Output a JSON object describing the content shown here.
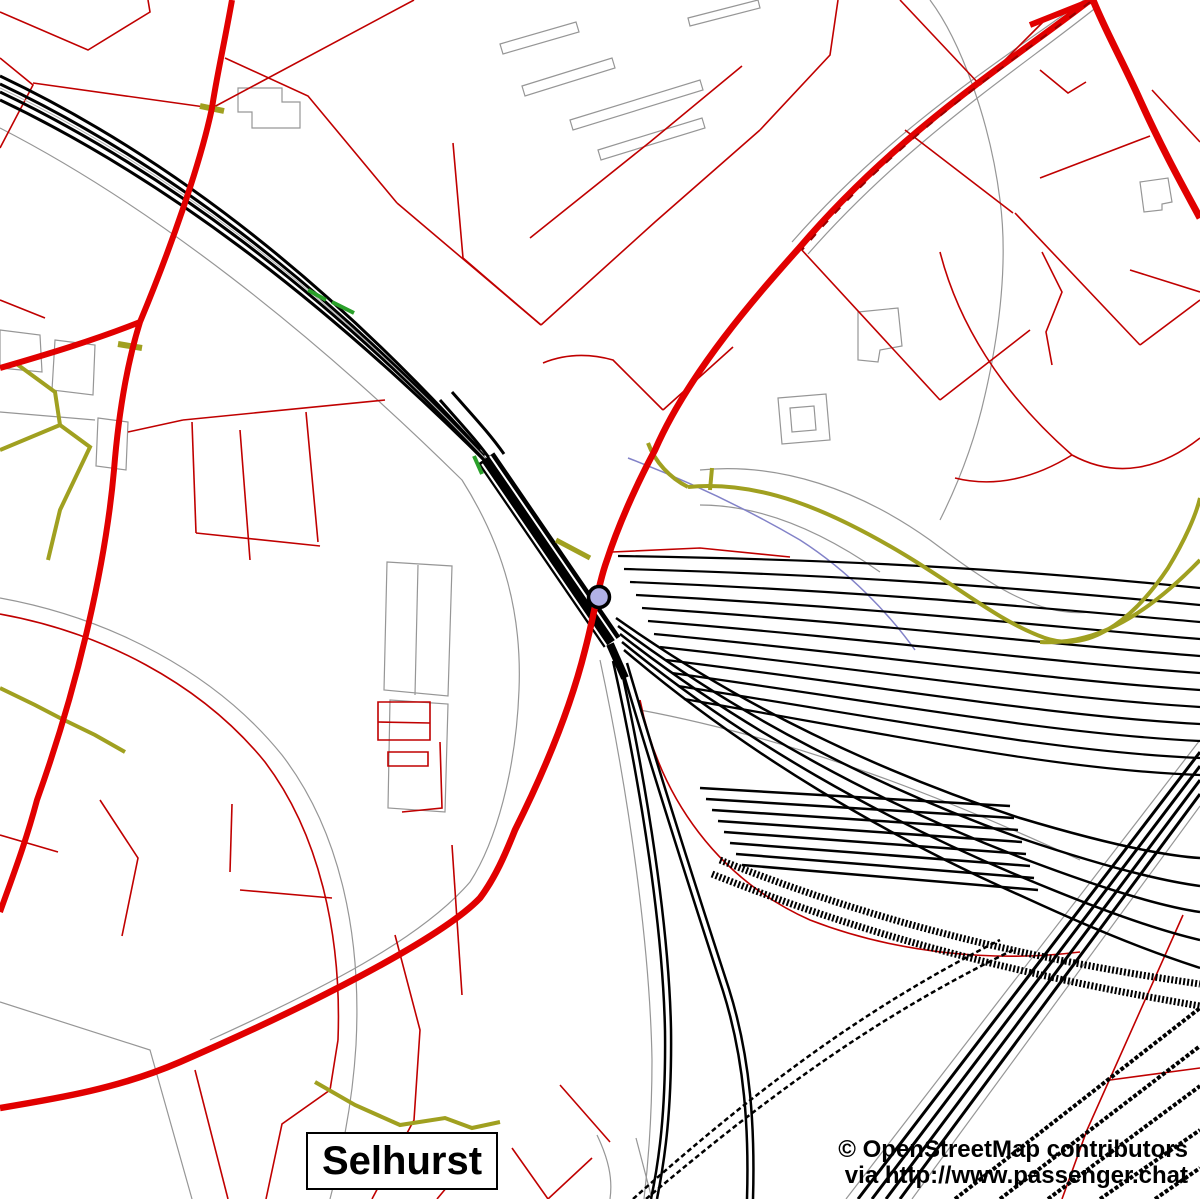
{
  "map": {
    "place_label": "Selhurst",
    "attribution": {
      "line1": "© OpenStreetMap contributors",
      "line2": "via http://www.passenger.chat"
    },
    "station_marker": {
      "shape": "circle",
      "cx": 599,
      "cy": 597,
      "radius": 10.5
    },
    "colors": {
      "background": "#ffffff",
      "railway": "#000000",
      "railway_center": "#b0b0b0",
      "primary_road": "#e10000",
      "minor_road": "#c00000",
      "footpath": "#a0a020",
      "crossing_green": "#2aa02a",
      "stream": "#8282c8",
      "outline": "#969696",
      "station_fill": "#b0b0e6",
      "station_ring": "#000000",
      "label_text": "#000000"
    }
  }
}
